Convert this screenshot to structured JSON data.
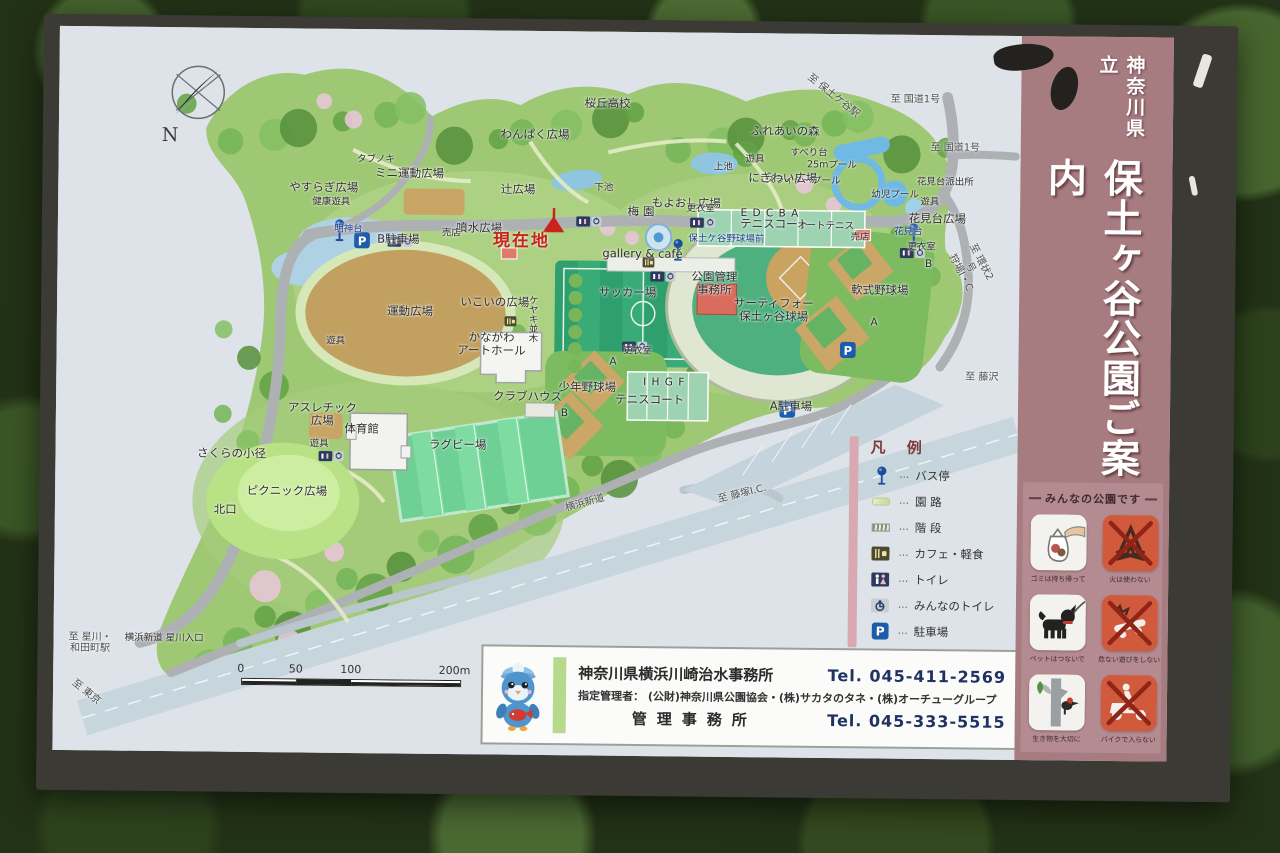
{
  "sign": {
    "prefecture_label": "神奈川県立",
    "title": "保土ヶ谷公園ご案内"
  },
  "map": {
    "compass_label": "N",
    "parking_letter": "P",
    "labels": [
      {
        "t": "桜丘高校",
        "x": 57,
        "y": 10,
        "c": "place"
      },
      {
        "t": "わんぱく広場",
        "x": 49.5,
        "y": 14.3,
        "c": "place"
      },
      {
        "t": "ふれあいの森",
        "x": 75.5,
        "y": 13.6,
        "c": "place"
      },
      {
        "t": "遊具",
        "x": 72.4,
        "y": 17.6,
        "c": "small"
      },
      {
        "t": "すべり台",
        "x": 78,
        "y": 16.6,
        "c": "small"
      },
      {
        "t": "25mプール",
        "x": 80.4,
        "y": 18.2,
        "c": "small"
      },
      {
        "t": "スライダープール",
        "x": 77.4,
        "y": 20.4,
        "c": "small"
      },
      {
        "t": "幼児プール",
        "x": 87,
        "y": 22.2,
        "c": "small"
      },
      {
        "t": "至 保土ケ谷駅",
        "x": 80.5,
        "y": 8.6,
        "c": "dir",
        "r": 38
      },
      {
        "t": "至 国道1号",
        "x": 89,
        "y": 9,
        "c": "dir"
      },
      {
        "t": "至 国道1号",
        "x": 93.2,
        "y": 15.6,
        "c": "dir"
      },
      {
        "t": "花見台派出所",
        "x": 92.2,
        "y": 20.5,
        "c": "small"
      },
      {
        "t": "遊具",
        "x": 90.6,
        "y": 23.2,
        "c": "small"
      },
      {
        "t": "花見台広場",
        "x": 91.4,
        "y": 25.4,
        "c": "place"
      },
      {
        "t": "花見台",
        "x": 88.4,
        "y": 27.4,
        "c": "bus"
      },
      {
        "t": "更衣室",
        "x": 89.8,
        "y": 29.4,
        "c": "small"
      },
      {
        "t": "B",
        "x": 90.6,
        "y": 31.6,
        "c": "letter"
      },
      {
        "t": "軟式野球場",
        "x": 85.5,
        "y": 35.4,
        "c": "place"
      },
      {
        "t": "A",
        "x": 85,
        "y": 39.8,
        "c": "letter"
      },
      {
        "t": "売店",
        "x": 83.4,
        "y": 28.2,
        "c": "small"
      },
      {
        "t": "タブノキ",
        "x": 33,
        "y": 18.1,
        "c": "small"
      },
      {
        "t": "ミニ運動広場",
        "x": 36.5,
        "y": 19.9,
        "c": "place"
      },
      {
        "t": "やすらぎ広場",
        "x": 27.6,
        "y": 21.9,
        "c": "place"
      },
      {
        "t": "健康遊具",
        "x": 28.4,
        "y": 24,
        "c": "small"
      },
      {
        "t": "辻広場",
        "x": 47.8,
        "y": 21.9,
        "c": "place"
      },
      {
        "t": "下池",
        "x": 56.7,
        "y": 21.7,
        "c": "small"
      },
      {
        "t": "上池",
        "x": 69.1,
        "y": 18.6,
        "c": "small"
      },
      {
        "t": "にぎわい広場",
        "x": 75.3,
        "y": 20,
        "c": "place"
      },
      {
        "t": "もよおし広場",
        "x": 65.3,
        "y": 23.6,
        "c": "place"
      },
      {
        "t": "梅 園",
        "x": 60.6,
        "y": 24.8,
        "c": "place"
      },
      {
        "t": "更衣室",
        "x": 66.8,
        "y": 24.4,
        "c": "small"
      },
      {
        "t": "E   D   C   B   A",
        "x": 74,
        "y": 24.8,
        "c": "letter"
      },
      {
        "t": "テニスコート",
        "x": 74.5,
        "y": 26.4,
        "c": "place"
      },
      {
        "t": "オートテニス",
        "x": 79.8,
        "y": 26.6,
        "c": "small"
      },
      {
        "t": "保土ケ谷野球場前",
        "x": 69.5,
        "y": 28.6,
        "c": "bus"
      },
      {
        "t": "噴水広場",
        "x": 43.8,
        "y": 27.3,
        "c": "place"
      },
      {
        "t": "現在地",
        "x": 48.2,
        "y": 29.2,
        "c": "current"
      },
      {
        "t": "売店",
        "x": 40.9,
        "y": 28.2,
        "c": "small"
      },
      {
        "t": "明神台",
        "x": 30.2,
        "y": 27.7,
        "c": "bus"
      },
      {
        "t": "B駐車場",
        "x": 35.4,
        "y": 29,
        "c": "place"
      },
      {
        "t": "gallery & café",
        "x": 60.8,
        "y": 30.7,
        "c": "place"
      },
      {
        "t": "公園管理\n事務所",
        "x": 68.3,
        "y": 34.6,
        "c": "place"
      },
      {
        "t": "サーティフォー\n保土ヶ谷球場",
        "x": 74.5,
        "y": 38.2,
        "c": "place"
      },
      {
        "t": "サッカー場",
        "x": 59.3,
        "y": 36,
        "c": "place"
      },
      {
        "t": "運動広場",
        "x": 36.7,
        "y": 38.9,
        "c": "place"
      },
      {
        "t": "いこいの広場",
        "x": 45.5,
        "y": 37.5,
        "c": "place"
      },
      {
        "t": "ケヤキ並木",
        "x": 49.3,
        "y": 39.8,
        "c": "small",
        "v": true
      },
      {
        "t": "かながわ\nアートホール",
        "x": 45.2,
        "y": 43.4,
        "c": "place"
      },
      {
        "t": "更衣室",
        "x": 60.4,
        "y": 44.2,
        "c": "small"
      },
      {
        "t": "A",
        "x": 57.9,
        "y": 45.6,
        "c": "letter"
      },
      {
        "t": "少年野球場",
        "x": 55.2,
        "y": 49.2,
        "c": "place"
      },
      {
        "t": "B",
        "x": 52.9,
        "y": 52.7,
        "c": "letter"
      },
      {
        "t": "クラブハウス",
        "x": 49,
        "y": 50.5,
        "c": "place"
      },
      {
        "t": "I   H   G   F",
        "x": 63.2,
        "y": 48.3,
        "c": "letter"
      },
      {
        "t": "テニスコート",
        "x": 61.7,
        "y": 50.8,
        "c": "place"
      },
      {
        "t": "A駐車場",
        "x": 76.4,
        "y": 51.5,
        "c": "place"
      },
      {
        "t": "遊具",
        "x": 29,
        "y": 43.2,
        "c": "small"
      },
      {
        "t": "アスレチック\n広場",
        "x": 27.7,
        "y": 53.3,
        "c": "place"
      },
      {
        "t": "体育館",
        "x": 31.8,
        "y": 55.3,
        "c": "place"
      },
      {
        "t": "遊具",
        "x": 27.4,
        "y": 57.4,
        "c": "small"
      },
      {
        "t": "ラグビー場",
        "x": 41.8,
        "y": 57.3,
        "c": "place"
      },
      {
        "t": "さくらの小径",
        "x": 18.3,
        "y": 58.8,
        "c": "place"
      },
      {
        "t": "ピクニック広場",
        "x": 24.1,
        "y": 64,
        "c": "place"
      },
      {
        "t": "北口",
        "x": 17.7,
        "y": 66.6,
        "c": "place"
      },
      {
        "t": "至 星川・\n和田町駅",
        "x": 3.8,
        "y": 85.2,
        "c": "dir"
      },
      {
        "t": "横浜新道 星川入口",
        "x": 11.5,
        "y": 84.5,
        "c": "small"
      },
      {
        "t": "至 東京",
        "x": 3.4,
        "y": 92,
        "c": "dir",
        "r": 38
      },
      {
        "t": "横浜新道",
        "x": 55.1,
        "y": 65.2,
        "c": "dir",
        "r": -16
      },
      {
        "t": "至 藤塚I.C.",
        "x": 71.4,
        "y": 63.7,
        "c": "dir",
        "r": -14
      },
      {
        "t": "至 藤沢",
        "x": 96.2,
        "y": 47.3,
        "c": "dir"
      },
      {
        "t": "至 環状2号\n狩場I・C",
        "x": 94.9,
        "y": 32,
        "c": "dir",
        "r": 62
      }
    ],
    "scale": {
      "ticks": [
        "0",
        "50",
        "100",
        "200m"
      ]
    }
  },
  "legend": {
    "title": "凡 例",
    "separator": "…",
    "items": [
      {
        "icon": "bus-stop",
        "label": "バス停"
      },
      {
        "icon": "path",
        "label": "園 路"
      },
      {
        "icon": "stairs",
        "label": "階 段"
      },
      {
        "icon": "cafe",
        "label": "カフェ・軽食"
      },
      {
        "icon": "toilet",
        "label": "トイレ"
      },
      {
        "icon": "accessible-toilet",
        "label": "みんなのトイレ"
      },
      {
        "icon": "parking",
        "label": "駐車場"
      }
    ]
  },
  "rules": {
    "title": "みんなの公園です",
    "items": [
      {
        "icon": "trash-bag",
        "label": "ゴミは持ち帰って",
        "prohibition": false
      },
      {
        "icon": "no-fire",
        "label": "火は使わない",
        "prohibition": true
      },
      {
        "icon": "dog-leash",
        "label": "ペットはつないで",
        "prohibition": false
      },
      {
        "icon": "no-skateboard",
        "label": "危ない遊びをしない",
        "prohibition": true
      },
      {
        "icon": "woodpecker",
        "label": "生き物を大切に",
        "prohibition": false
      },
      {
        "icon": "no-motorbike",
        "label": "バイクで入らない",
        "prohibition": true
      }
    ]
  },
  "contact": {
    "office_name": "神奈川県横浜川崎治水事務所",
    "office_tel": "Tel. 045-411-2569",
    "manager_line": "指定管理者： (公財)神奈川県公園協会・(株)サカタのタネ・(株)オーチューグループ",
    "admin_name": "管理事務所",
    "admin_tel": "Tel. 045-333-5515"
  },
  "colors": {
    "title_strip": "#a67c80",
    "frame": "#3b3a34",
    "map_bg": "#dde3e8",
    "park_green": "#9ec873",
    "field_green": "#2f9f6d",
    "infield_tan": "#c2a160",
    "road_gray": "#adb1b4",
    "expressway": "#c7d6dd",
    "current_red": "#c8231c",
    "bus_blue": "#1d4e9e",
    "prohibition_red": "#d15a3d"
  }
}
